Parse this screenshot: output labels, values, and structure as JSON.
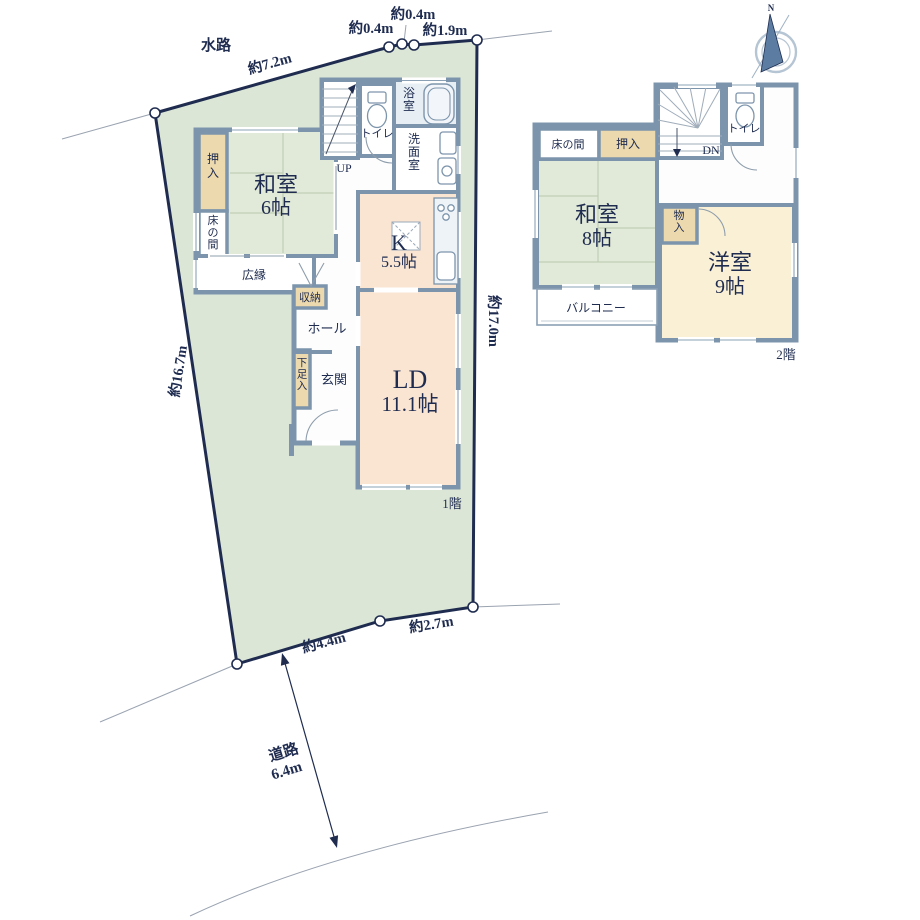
{
  "colors": {
    "plot_fill": "#dce6d7",
    "plot_border": "#1f2c50",
    "wall": "#7d95ac",
    "tatami_green": "#e1e9d8",
    "ld_peach": "#fae5d3",
    "youshitsu_cream": "#faf0d5",
    "closet_tan": "#ecd9ad",
    "bath_blue": "#e7eff5",
    "text_navy": "#1f2c50"
  },
  "site": {
    "waterway": "水路",
    "road_name": "道路",
    "road_width": "6.4m",
    "dim_top": "約7.2m",
    "dim_top_a": "約0.4m",
    "dim_top_b": "約0.4m",
    "dim_top_c": "約1.9m",
    "dim_right": "約17.0m",
    "dim_left": "約16.7m",
    "dim_bottom_a": "約4.4m",
    "dim_bottom_b": "約2.7m"
  },
  "compass": {
    "north": "N"
  },
  "floor1": {
    "label": "1階",
    "washitsu_name": "和室",
    "washitsu_size": "6帖",
    "oshiire": "押入",
    "tokonoma": "床の間",
    "hiroen": "広縁",
    "shuno": "収納",
    "hall": "ホール",
    "genkan": "玄関",
    "getabako": "下足入",
    "toilet": "トイレ",
    "bath": "浴室",
    "senmen": "洗面室",
    "kitchen_name": "K",
    "kitchen_size": "5.5帖",
    "ld_name": "LD",
    "ld_size": "11.1帖",
    "up": "UP"
  },
  "floor2": {
    "label": "2階",
    "washitsu_name": "和室",
    "washitsu_size": "8帖",
    "youshitsu_name": "洋室",
    "youshitsu_size": "9帖",
    "tokonoma": "床の間",
    "oshiire": "押入",
    "monoire": "物入",
    "balcony": "バルコニー",
    "toilet": "トイレ",
    "dn": "DN"
  }
}
